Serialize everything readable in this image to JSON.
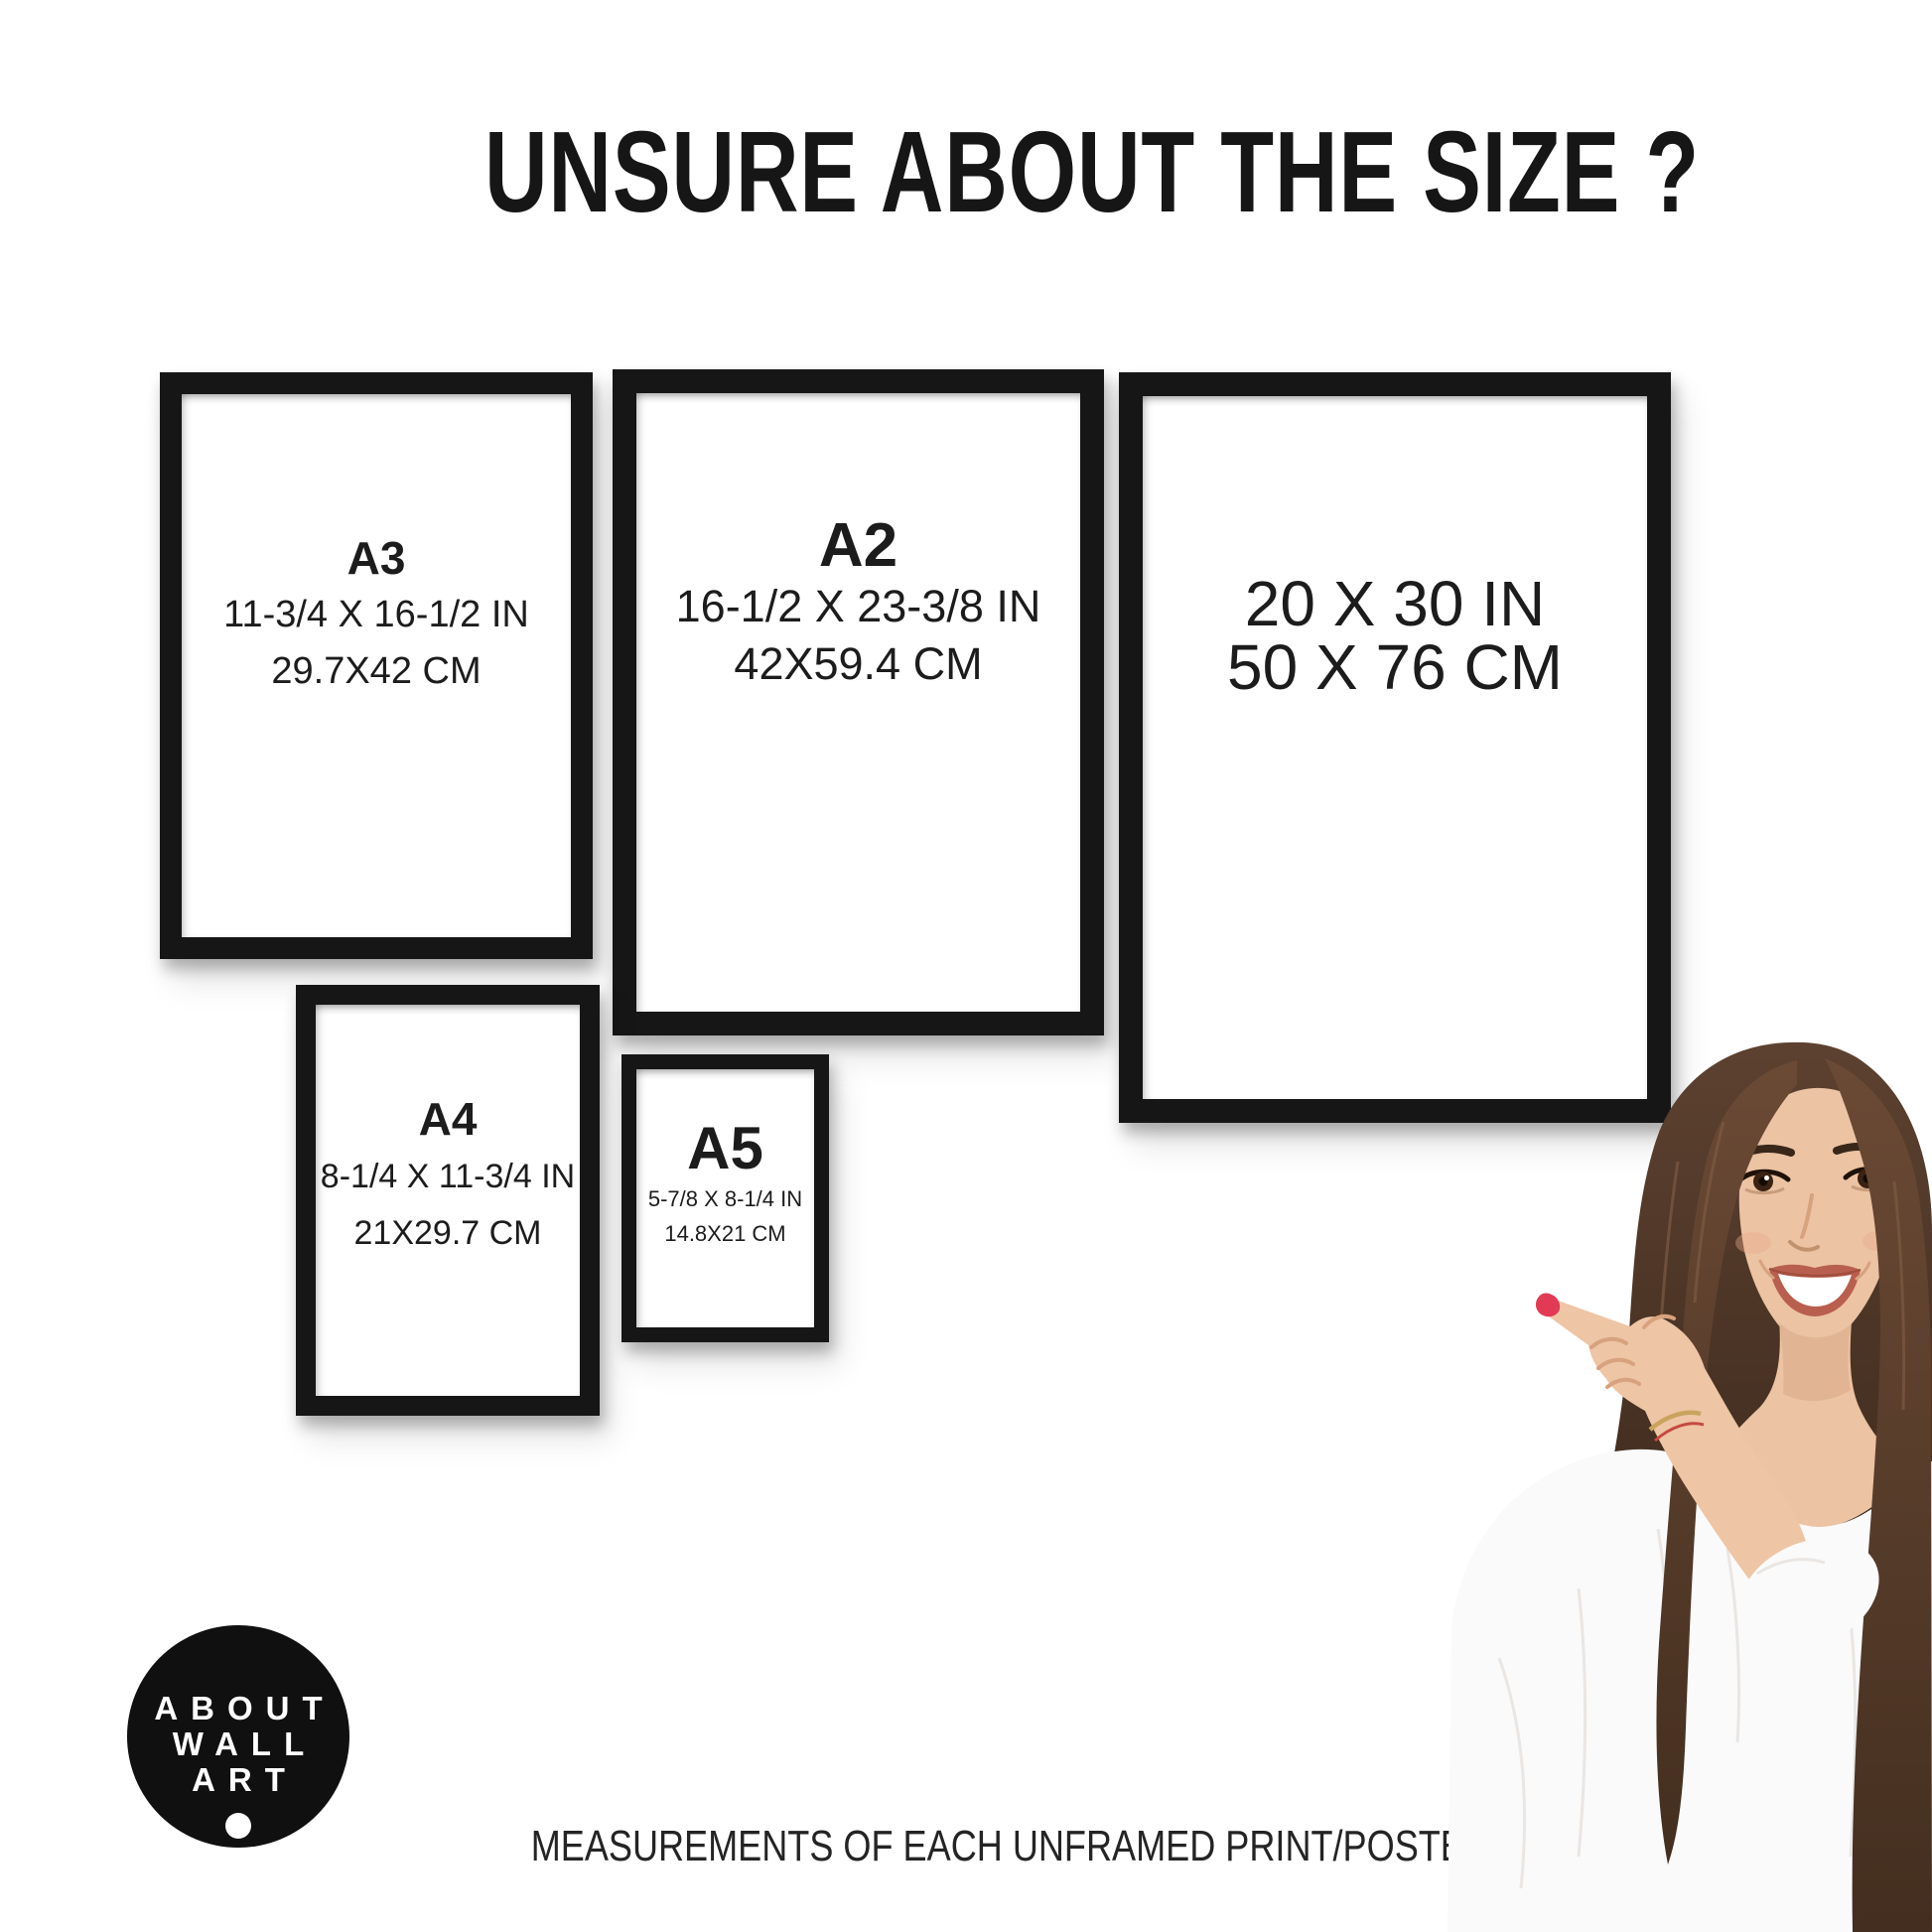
{
  "title": "UNSURE ABOUT THE SIZE ?",
  "footer": "MEASUREMENTS OF EACH UNFRAMED PRINT/POSTER",
  "logo": {
    "line1": "ABOUT",
    "line2": "WALL",
    "line3": "ART"
  },
  "frames": {
    "a3": {
      "label": "A3",
      "inches": "11-3/4 X 16-1/2 IN",
      "cm": "29.7X42 CM"
    },
    "a2": {
      "label": "A2",
      "inches": "16-1/2 X 23-3/8 IN",
      "cm": "42X59.4 CM"
    },
    "p2030": {
      "inches": "20 X 30 IN",
      "cm": "50 X 76 CM"
    },
    "a4": {
      "label": "A4",
      "inches": "8-1/4 X 11-3/4 IN",
      "cm": "21X29.7 CM"
    },
    "a5": {
      "label": "A5",
      "inches": "5-7/8 X 8-1/4 IN",
      "cm": "14.8X21 CM"
    }
  },
  "colors": {
    "background": "#ffffff",
    "frame": "#161616",
    "text": "#1c1c1c",
    "logo_bg": "#101010",
    "logo_text": "#ffffff",
    "nail_polish": "#e23a55",
    "hair": "#4a3323",
    "skin": "#ecc3a3",
    "blouse": "#fbfafa"
  }
}
